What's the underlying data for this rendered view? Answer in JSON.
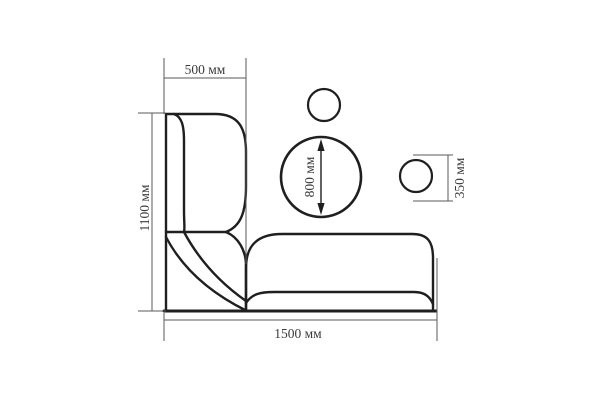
{
  "diagram": {
    "kind": "corner-sofa-and-round-tables-dimension-drawing",
    "unit": "мм",
    "labels": {
      "top_width": "500 мм",
      "left_height": "1100 мм",
      "bottom_length": "1500 мм",
      "large_table_diameter": "800 мм",
      "small_table_diameter": "350 мм"
    }
  },
  "colors": {
    "outline": "#1f1f1f",
    "dimension": "#5a5a5a",
    "text": "#3a3a3a",
    "bg": "#ffffff"
  }
}
